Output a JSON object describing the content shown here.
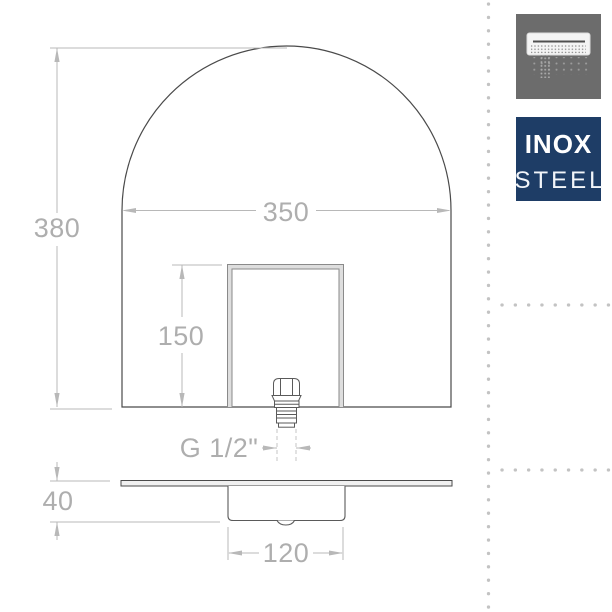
{
  "page": {
    "background_color": "#ffffff",
    "separator_dot_color": "#c3c3c3"
  },
  "drawing": {
    "line_color_dark": "#4a4a4a",
    "line_color_dim": "#b8b8b8",
    "front_view": {
      "overall_height_label": "380",
      "overall_width_label": "350",
      "cutout_height_label": "150",
      "thread_label": "G 1/2\""
    },
    "bottom_view": {
      "depth_label": "40",
      "box_width_label": "120"
    }
  },
  "sidebar": {
    "product_icon": {
      "name": "rectangular-shower-head-icon",
      "bg_color": "#6c6c6c"
    },
    "material_badge": {
      "line1": "INOX",
      "line2": "STEEL",
      "bg_color": "#1e3d66",
      "text_color": "#ffffff"
    }
  }
}
